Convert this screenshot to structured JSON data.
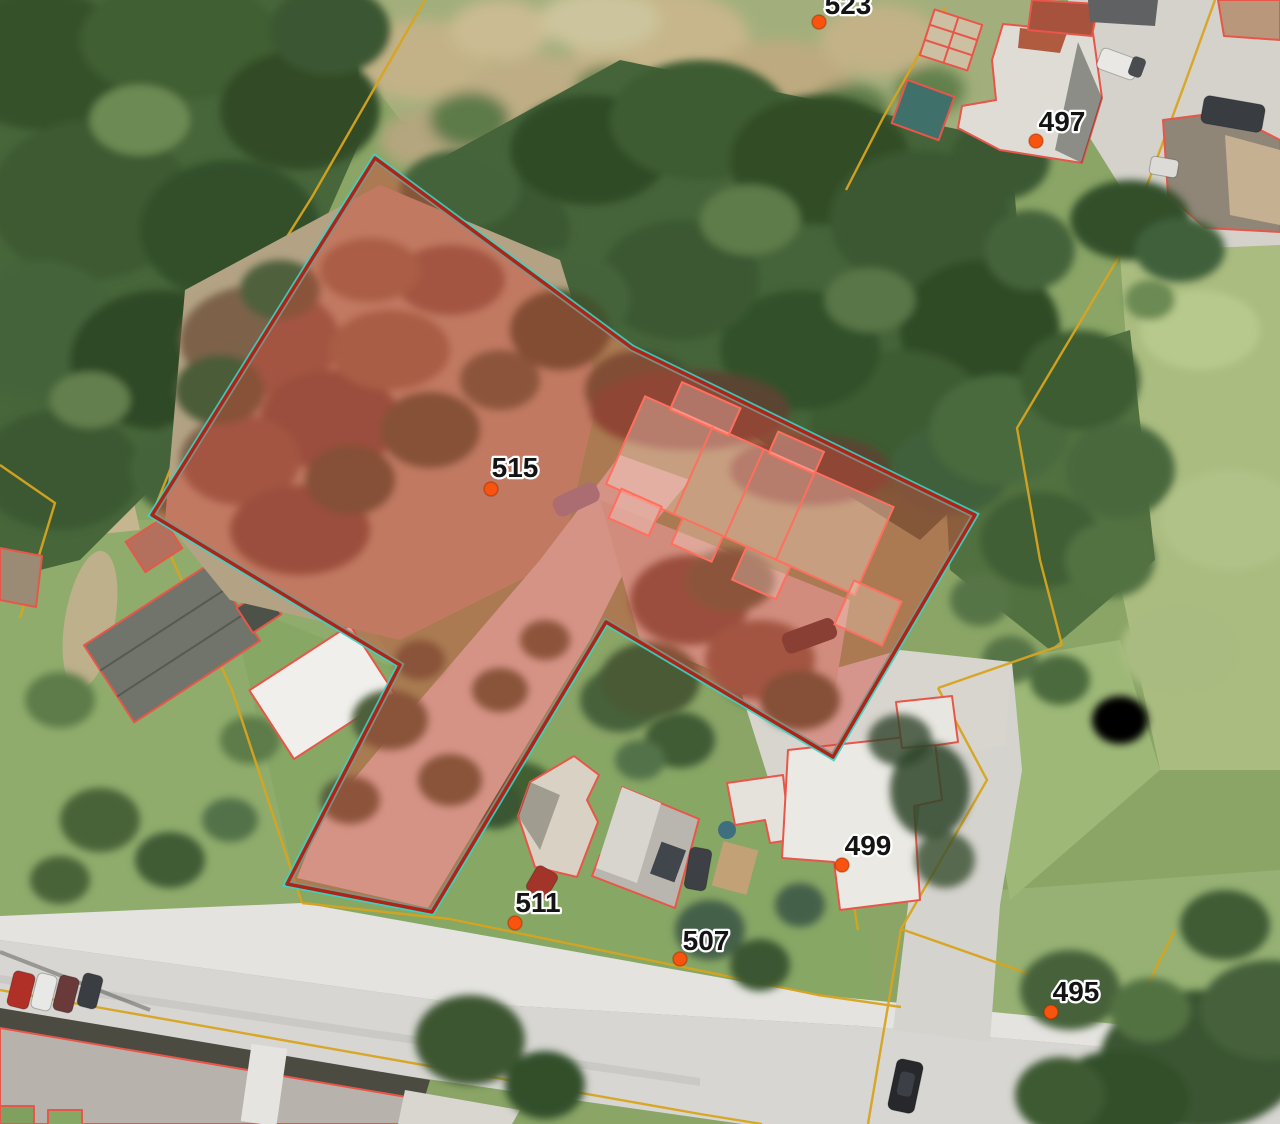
{
  "map": {
    "view": "aerial-parcel-viewer",
    "selected_parcel": {
      "address_label": "515"
    },
    "labels": [
      {
        "text": "523",
        "x": 848,
        "y": 14,
        "dot": [
          819,
          22
        ]
      },
      {
        "text": "497",
        "x": 1062,
        "y": 131,
        "dot": [
          1036,
          141
        ]
      },
      {
        "text": "515",
        "x": 515,
        "y": 477,
        "dot": [
          491,
          489
        ]
      },
      {
        "text": "499",
        "x": 868,
        "y": 855,
        "dot": [
          842,
          865
        ]
      },
      {
        "text": "511",
        "x": 538,
        "y": 912,
        "dot": [
          515,
          923
        ]
      },
      {
        "text": "507",
        "x": 706,
        "y": 950,
        "dot": [
          680,
          959
        ]
      },
      {
        "text": "495",
        "x": 1076,
        "y": 1001,
        "dot": [
          1051,
          1012
        ]
      }
    ],
    "colors": {
      "parcel_boundary_yellow": "#d8a41f",
      "building_outline_red": "#e8564a",
      "selected_fill": "rgba(210,72,58,0.45)",
      "selected_border": "#ae2417",
      "selection_accent_cyan": "#3bd2c7",
      "marker_orange": "#f8530f",
      "label_text": "#141414",
      "label_halo": "#ffffff"
    }
  }
}
